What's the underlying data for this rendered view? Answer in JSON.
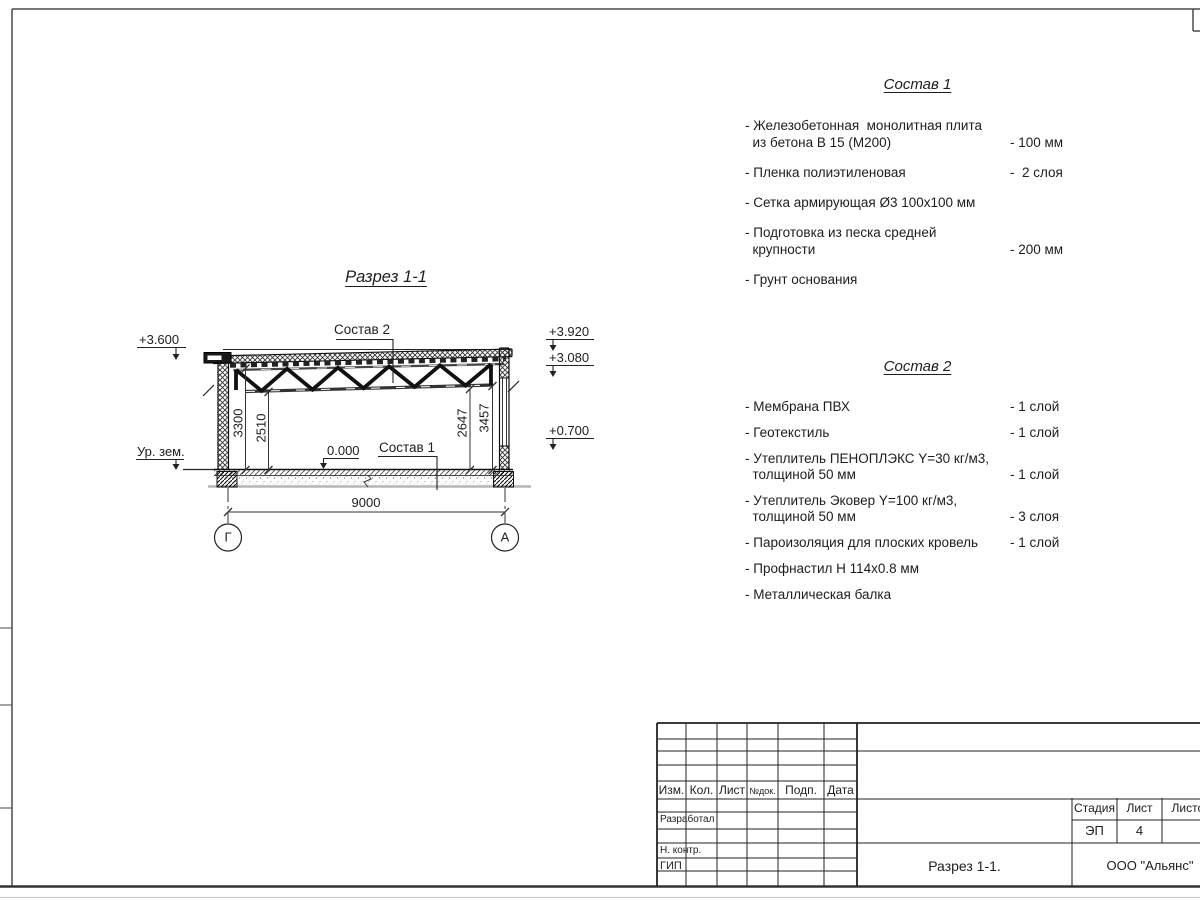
{
  "drawing": {
    "title": "Разрез 1-1",
    "labels": {
      "sostav1": "Состав 1",
      "sostav2": "Состав 2",
      "ground": "Ур. зем.",
      "zero": "0.000"
    },
    "elevations": {
      "left_top": "+3.600",
      "right_top": "+3.920",
      "right_mid": "+3.080",
      "right_low": "+0.700"
    },
    "dims": {
      "span": "9000",
      "left_outer": "3300",
      "left_inner": "2510",
      "right_inner": "2647",
      "right_outer": "3457"
    },
    "axes": {
      "left": "Г",
      "right": "А"
    }
  },
  "sostav1": {
    "title": "Состав 1",
    "items": [
      {
        "text": "- Железобетонная  монолитная плита",
        "text2": "  из бетона В 15 (М200)",
        "value": "- 100 мм"
      },
      {
        "text": "- Пленка полиэтиленовая",
        "value": "-  2 слоя"
      },
      {
        "text": "- Сетка армирующая Ø3 100х100 мм",
        "value": ""
      },
      {
        "text": "- Подготовка из песка средней",
        "text2": "  крупности",
        "value": "- 200 мм"
      },
      {
        "text": "- Грунт основания",
        "value": ""
      }
    ]
  },
  "sostav2": {
    "title": "Состав 2",
    "items": [
      {
        "text": "- Мембрана ПВХ",
        "value": "- 1 слой"
      },
      {
        "text": "- Геотекстиль",
        "value": "- 1 слой"
      },
      {
        "text": "- Утеплитель ПЕНОПЛЭКС Y=30 кг/м3,",
        "text2": "  толщиной 50 мм",
        "value": "- 1 слой"
      },
      {
        "text": "- Утеплитель Эковер Y=100 кг/м3,",
        "text2": "  толщиной 50 мм",
        "value": "- 3 слоя"
      },
      {
        "text": "- Пароизоляция для плоских кровель",
        "value": "- 1 слой"
      },
      {
        "text": "- Профнастил Н 114х0.8 мм",
        "value": ""
      },
      {
        "text": "- Металлическая балка",
        "value": ""
      }
    ]
  },
  "titleblock": {
    "header_cols": [
      "Изм.",
      "Кол.",
      "Лист",
      "№док.",
      "Подп.",
      "Дата"
    ],
    "sign_rows": [
      "Разработал",
      "Н. контр.",
      "ГИП"
    ],
    "stage_label": "Стадия",
    "sheet_label": "Лист",
    "sheets_label": "Листов",
    "stage_value": "ЭП",
    "sheet_value": "4",
    "doc_title": "Разрез 1-1.",
    "company": "ООО \"Альянс\""
  }
}
